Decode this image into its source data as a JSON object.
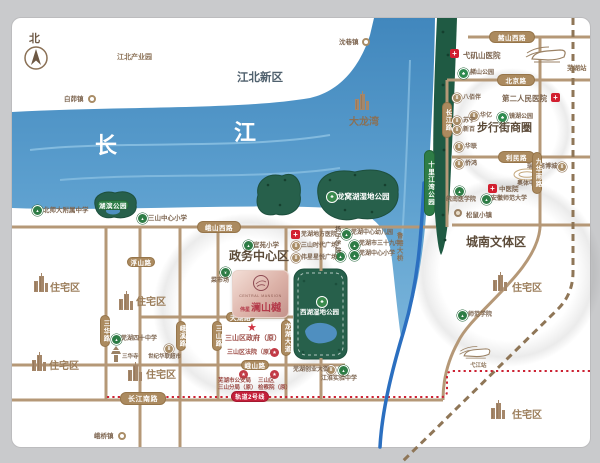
{
  "compass": {
    "label": "北"
  },
  "project": {
    "name_en": "CENTRAL MANSION",
    "prefix": "伟星",
    "name_cn": "澜山樾"
  },
  "colors": {
    "road": "#b59877",
    "river": "#5598c8",
    "park_green": "#27604b",
    "strip_green": "#1f5a43",
    "red_dotted": "#cc2233",
    "railway": "#8f7657",
    "expressway": "#2b6fc0",
    "pill": "#ab8a5f",
    "metro_red": "#c41f3a"
  },
  "texts": [
    {
      "name": "label-jiangbei-industrial-park",
      "t": "江北产业园",
      "x": 117,
      "y": 54,
      "fs": 7,
      "c": "#8a7055",
      "b": 1
    },
    {
      "name": "label-jiangbei-new-district",
      "t": "江北新区",
      "x": 237,
      "y": 72,
      "fs": 11.5,
      "c": "#50616e",
      "b": 1
    },
    {
      "name": "label-dalongwan",
      "t": "大龙湾",
      "x": 349,
      "y": 117,
      "fs": 10,
      "c": "#8a7055",
      "b": 1
    },
    {
      "name": "label-yangtze-char-1",
      "t": "长",
      "x": 95,
      "y": 134,
      "fs": 22,
      "c": "#ffffff",
      "b": 1
    },
    {
      "name": "label-yangtze-char-2",
      "t": "江",
      "x": 234,
      "y": 121,
      "fs": 22,
      "c": "#ffffff",
      "b": 1
    },
    {
      "name": "label-walking-street-area",
      "t": "步行街商圈",
      "x": 477,
      "y": 122,
      "fs": 11,
      "c": "#5d4c3a",
      "b": 1
    },
    {
      "name": "label-govt-center-area",
      "t": "政务中心区",
      "x": 229,
      "y": 250,
      "fs": 12,
      "c": "#5d4c3a",
      "b": 1
    },
    {
      "name": "label-chengnan-area",
      "t": "城南文体区",
      "x": 466,
      "y": 236,
      "fs": 12,
      "c": "#5d4c3a",
      "b": 1
    },
    {
      "name": "label-residential-1",
      "t": "住宅区",
      "x": 50,
      "y": 283,
      "fs": 10,
      "c": "#9b7d5a",
      "b": 1
    },
    {
      "name": "label-residential-2",
      "t": "住宅区",
      "x": 136,
      "y": 297,
      "fs": 10,
      "c": "#9b7d5a",
      "b": 1
    },
    {
      "name": "label-residential-3",
      "t": "住宅区",
      "x": 49,
      "y": 361,
      "fs": 10,
      "c": "#9b7d5a",
      "b": 1
    },
    {
      "name": "label-residential-4",
      "t": "住宅区",
      "x": 146,
      "y": 370,
      "fs": 10,
      "c": "#9b7d5a",
      "b": 1
    },
    {
      "name": "label-residential-5",
      "t": "住宅区",
      "x": 512,
      "y": 283,
      "fs": 10,
      "c": "#9b7d5a",
      "b": 1
    },
    {
      "name": "label-residential-6",
      "t": "住宅区",
      "x": 512,
      "y": 410,
      "fs": 10,
      "c": "#9b7d5a",
      "b": 1
    },
    {
      "name": "label-wuhu-station",
      "t": "芜湖站",
      "x": 567,
      "y": 65,
      "fs": 6.5,
      "c": "#8a7055",
      "b": 1
    },
    {
      "name": "label-yijiang-station",
      "t": "弋江站",
      "x": 470,
      "y": 363,
      "fs": 5.5,
      "c": "#8a7055",
      "b": 1
    },
    {
      "name": "label-lugang-bridge",
      "t": "鲁港大桥",
      "x": 395,
      "y": 232,
      "fs": 6.5,
      "c": "#8a7055",
      "b": 1,
      "v": 1
    },
    {
      "name": "label-yangzi-college",
      "t": "扬子学院",
      "x": 333,
      "y": 226,
      "fs": 6,
      "c": "#6d5844",
      "b": 1,
      "v": 1
    },
    {
      "name": "label-longwo-park",
      "t": "龙窝湖湿地公园",
      "x": 337,
      "y": 193,
      "fs": 7.5,
      "c": "#ffffff",
      "b": 1
    },
    {
      "name": "label-xihu-park",
      "t": "西湖湿地公园",
      "x": 300,
      "y": 309,
      "fs": 6.5,
      "c": "#ffffff",
      "b": 1
    }
  ],
  "pois": [
    {
      "name": "baimao-town",
      "type": "town",
      "ix": 88,
      "iy": 95,
      "label": "白茆镇",
      "lx": 64,
      "ly": 96,
      "fs": 6.5
    },
    {
      "name": "shenxiang-town",
      "type": "town",
      "ix": 362,
      "iy": 38,
      "label": "沈巷镇",
      "lx": 339,
      "ly": 39,
      "fs": 6.5
    },
    {
      "name": "eqiao-town",
      "type": "town",
      "ix": 118,
      "iy": 432,
      "label": "峨桥镇",
      "lx": 94,
      "ly": 433,
      "fs": 6.5
    },
    {
      "name": "yijishan-hospital",
      "type": "hosp",
      "ix": 450,
      "iy": 49,
      "label": "弋矶山医院",
      "lx": 463,
      "ly": 51,
      "fs": 7.5
    },
    {
      "name": "second-peoples-hospital",
      "type": "hosp",
      "ix": 551,
      "iy": 93,
      "label": "第二人民医院",
      "lx": 502,
      "ly": 94,
      "fs": 7.5
    },
    {
      "name": "tcm-hospital",
      "type": "hosp",
      "ix": 488,
      "iy": 184,
      "label": "中医院",
      "lx": 499,
      "ly": 186,
      "fs": 6.5
    },
    {
      "name": "difang-hospital",
      "type": "hosp",
      "ix": 291,
      "iy": 230,
      "label": "芜湖地方医院",
      "lx": 301,
      "ly": 232,
      "fs": 6
    },
    {
      "name": "zheshan-park",
      "type": "park",
      "ix": 458,
      "iy": 68,
      "label": "赭山公园",
      "lx": 470,
      "ly": 70,
      "fs": 6
    },
    {
      "name": "jinghu-park",
      "type": "park",
      "ix": 497,
      "iy": 112,
      "label": "镜湖公园",
      "lx": 509,
      "ly": 114,
      "fs": 6
    },
    {
      "name": "babaiban",
      "type": "com",
      "ix": 452,
      "iy": 93,
      "label": "八佰伴",
      "lx": 463,
      "ly": 95,
      "fs": 6
    },
    {
      "name": "huayi",
      "type": "com",
      "ix": 469,
      "iy": 111,
      "label": "华亿",
      "lx": 480,
      "ly": 113,
      "fs": 6
    },
    {
      "name": "suning",
      "type": "com",
      "ix": 452,
      "iy": 116,
      "label": "苏宁",
      "lx": 463,
      "ly": 118,
      "fs": 6
    },
    {
      "name": "xinbai",
      "type": "com",
      "ix": 452,
      "iy": 125,
      "label": "新百",
      "lx": 463,
      "ly": 127,
      "fs": 6
    },
    {
      "name": "hualian",
      "type": "com",
      "ix": 454,
      "iy": 142,
      "label": "华联",
      "lx": 465,
      "ly": 144,
      "fs": 6
    },
    {
      "name": "qiaohong",
      "type": "com",
      "ix": 454,
      "iy": 159,
      "label": "侨鸿",
      "lx": 465,
      "ly": 161,
      "fs": 6
    },
    {
      "name": "ruifeng-mall",
      "type": "com",
      "ix": 557,
      "iy": 162,
      "label": "瑞丰商博城",
      "lx": 527,
      "ly": 164,
      "fs": 6
    },
    {
      "name": "aoti-center",
      "type": "stadium",
      "ix": 512,
      "iy": 167,
      "label": "奥体中心",
      "lx": 517,
      "ly": 181,
      "fs": 6
    },
    {
      "name": "wannan-medical-college",
      "type": "school",
      "ix": 454,
      "iy": 186,
      "label": "皖南医学院",
      "lx": 446,
      "ly": 197,
      "fs": 6
    },
    {
      "name": "anhui-normal-university",
      "type": "school",
      "ix": 481,
      "iy": 194,
      "label": "安徽师范大学",
      "lx": 491,
      "ly": 196,
      "fs": 6
    },
    {
      "name": "songshu-town",
      "type": "medal",
      "ix": 454,
      "iy": 209,
      "label": "松鼠小镇",
      "lx": 466,
      "ly": 212,
      "fs": 6.5
    },
    {
      "name": "shifan-college",
      "type": "school",
      "ix": 457,
      "iy": 310,
      "label": "师范学院",
      "lx": 468,
      "ly": 312,
      "fs": 6
    },
    {
      "name": "bnu-affiliated-school",
      "type": "school",
      "ix": 32,
      "iy": 205,
      "label": "北师大附属中学",
      "lx": 43,
      "ly": 207,
      "fs": 6.5
    },
    {
      "name": "sanshan-central-primary",
      "type": "school",
      "ix": 137,
      "iy": 213,
      "label": "三山中心小学",
      "lx": 148,
      "ly": 215,
      "fs": 6.5
    },
    {
      "name": "guanyuan-primary",
      "type": "school",
      "ix": 243,
      "iy": 240,
      "label": "官苑小学",
      "lx": 253,
      "ly": 242,
      "fs": 6.5
    },
    {
      "name": "wuhu-central-kindergarten",
      "type": "school",
      "ix": 341,
      "iy": 229,
      "label": "芜湖中心幼儿园",
      "lx": 351,
      "ly": 230,
      "fs": 6
    },
    {
      "name": "wuhu-no39-school",
      "type": "school",
      "ix": 349,
      "iy": 240,
      "label": "芜湖市三十九中",
      "lx": 359,
      "ly": 241,
      "fs": 6
    },
    {
      "name": "wuhu-central-primary",
      "type": "school",
      "ix": 349,
      "iy": 250,
      "label": "芜湖中心小学",
      "lx": 359,
      "ly": 251,
      "fs": 6
    },
    {
      "name": "yangzi-college-marker",
      "type": "school",
      "ix": 335,
      "iy": 251
    },
    {
      "name": "shidai-plaza",
      "type": "com",
      "ix": 291,
      "iy": 241,
      "label": "三山时代广场",
      "lx": 301,
      "ly": 243,
      "fs": 6
    },
    {
      "name": "weixing-plaza",
      "type": "com",
      "ix": 291,
      "iy": 253,
      "label": "伟星星悦广场",
      "lx": 301,
      "ly": 255,
      "fs": 6
    },
    {
      "name": "vegetable-market",
      "type": "greenc",
      "ix": 220,
      "iy": 267,
      "label": "菜市场",
      "lx": 211,
      "ly": 278,
      "fs": 6
    },
    {
      "name": "experience-center",
      "type": "gov",
      "ix": 273,
      "iy": 273,
      "label": "体验中心",
      "lx": 268,
      "ly": 284,
      "fs": 4.5,
      "lc": "#a34952"
    },
    {
      "name": "commercial-center",
      "type": "gov",
      "ix": 273,
      "iy": 293,
      "label": "商业中心",
      "lx": 268,
      "ly": 304,
      "fs": 4.5,
      "lc": "#a34952"
    },
    {
      "name": "sanshan-government",
      "type": "star",
      "ix": 247,
      "iy": 321,
      "label": "三山区政府（原）",
      "lx": 225,
      "ly": 334,
      "fs": 7,
      "lc": "#9c4a44"
    },
    {
      "name": "sanshan-court",
      "type": "gov",
      "ix": 270,
      "iy": 348,
      "label": "三山区法院（原）",
      "lx": 227,
      "ly": 350,
      "fs": 6,
      "lc": "#9c4a44"
    },
    {
      "name": "public-security-bureau",
      "type": "gov",
      "ix": 239,
      "iy": 370,
      "label": "芜湖市公安局\n三山分局（原）",
      "lx": 218,
      "ly": 378,
      "fs": 5.5,
      "lc": "#9c4a44"
    },
    {
      "name": "procuratorate",
      "type": "gov",
      "ix": 270,
      "iy": 370,
      "label": "三山区\n检察院（原）",
      "lx": 258,
      "ly": 378,
      "fs": 5.5,
      "lc": "#9c4a44"
    },
    {
      "name": "chuangye-street",
      "type": "com",
      "ix": 326,
      "iy": 365,
      "label": "芜湖创业大街",
      "lx": 293,
      "ly": 367,
      "fs": 6
    },
    {
      "name": "jianghuai-school",
      "type": "school",
      "ix": 338,
      "iy": 365,
      "label": "江淮实验中学",
      "lx": 321,
      "ly": 376,
      "fs": 6
    },
    {
      "name": "wuhu-no40-school",
      "type": "school",
      "ix": 111,
      "iy": 334,
      "label": "芜湖四十中学",
      "lx": 121,
      "ly": 336,
      "fs": 6
    },
    {
      "name": "sanhua-temple",
      "type": "pagoda",
      "ix": 110,
      "iy": 346,
      "label": "三华寺",
      "lx": 122,
      "ly": 354,
      "fs": 5.5
    },
    {
      "name": "hualian-supermarket",
      "type": "com",
      "ix": 164,
      "iy": 344,
      "label": "世纪华联超市",
      "lx": 148,
      "ly": 354,
      "fs": 5.5
    },
    {
      "name": "longwo-park-marker",
      "type": "parkring",
      "ix": 326,
      "iy": 191
    },
    {
      "name": "xihu-park-marker",
      "type": "parkring",
      "ix": 316,
      "iy": 296
    },
    {
      "name": "dalongwan-building",
      "type": "bldg",
      "ix": 352,
      "iy": 90
    },
    {
      "name": "residential-building-1",
      "type": "bldg",
      "ix": 31,
      "iy": 272
    },
    {
      "name": "residential-building-2",
      "type": "bldg",
      "ix": 116,
      "iy": 290
    },
    {
      "name": "residential-building-3",
      "type": "bldg",
      "ix": 29,
      "iy": 351
    },
    {
      "name": "residential-building-4",
      "type": "bldg",
      "ix": 125,
      "iy": 361
    },
    {
      "name": "residential-building-5",
      "type": "bldg",
      "ix": 490,
      "iy": 271
    },
    {
      "name": "residential-building-6",
      "type": "bldg",
      "ix": 488,
      "iy": 399
    },
    {
      "name": "wuhu-station-train",
      "type": "train",
      "ix": 524,
      "iy": 44
    },
    {
      "name": "yijiang-station-train",
      "type": "train2",
      "ix": 458,
      "iy": 344
    }
  ],
  "pills": [
    {
      "name": "pill-zheshan-west-road",
      "label": "赭山西路",
      "x": 489,
      "y": 31,
      "w": 46,
      "h": 12
    },
    {
      "name": "pill-beijing-road",
      "label": "北京路",
      "x": 497,
      "y": 74,
      "w": 38,
      "h": 12
    },
    {
      "name": "pill-limin-road",
      "label": "利民路",
      "x": 498,
      "y": 151,
      "w": 37,
      "h": 12
    },
    {
      "name": "pill-eshan-west-road",
      "label": "峨山西路",
      "x": 197,
      "y": 221,
      "w": 44,
      "h": 12
    },
    {
      "name": "pill-fushan-road",
      "label": "浮山路",
      "x": 127,
      "y": 257,
      "w": 28,
      "h": 10
    },
    {
      "name": "pill-tianhu-road",
      "label": "天湖路",
      "x": 226,
      "y": 312,
      "w": 29,
      "h": 10
    },
    {
      "name": "pill-eshan-road",
      "label": "峨山路",
      "x": 241,
      "y": 360,
      "w": 28,
      "h": 10
    },
    {
      "name": "pill-changjiang-south-road",
      "label": "长江南路",
      "x": 120,
      "y": 392,
      "w": 46,
      "h": 13,
      "fs": 7
    },
    {
      "name": "pill-changjiang-road",
      "label": "长江路",
      "x": 442,
      "y": 102,
      "w": 10,
      "h": 36,
      "v": 1
    },
    {
      "name": "pill-jiuhua-south-road",
      "label": "九华南路",
      "x": 532,
      "y": 152,
      "w": 10,
      "h": 42,
      "v": 1
    },
    {
      "name": "pill-shili-jiangwan-park",
      "label": "十里江湾公园",
      "x": 424,
      "y": 150,
      "w": 11,
      "h": 66,
      "v": 1,
      "green": 1
    },
    {
      "name": "pill-hubin-park",
      "label": "湖滨公园",
      "x": 97,
      "y": 200,
      "w": 32,
      "h": 10,
      "green": 1
    },
    {
      "name": "pill-sanhua-road",
      "label": "三华路",
      "x": 100,
      "y": 315,
      "w": 10,
      "h": 32,
      "v": 1
    },
    {
      "name": "pill-exi-road",
      "label": "峨溪路",
      "x": 176,
      "y": 321,
      "w": 10,
      "h": 30,
      "v": 1
    },
    {
      "name": "pill-sanshan-road",
      "label": "三山路",
      "x": 212,
      "y": 321,
      "w": 10,
      "h": 30,
      "v": 1
    },
    {
      "name": "pill-longhu-avenue",
      "label": "龙湖大道",
      "x": 281,
      "y": 320,
      "w": 10,
      "h": 36,
      "v": 1
    },
    {
      "name": "pill-metro-line-2",
      "label": "轨道2号线",
      "x": 231,
      "y": 391,
      "w": 38,
      "h": 11,
      "red": 1
    }
  ]
}
